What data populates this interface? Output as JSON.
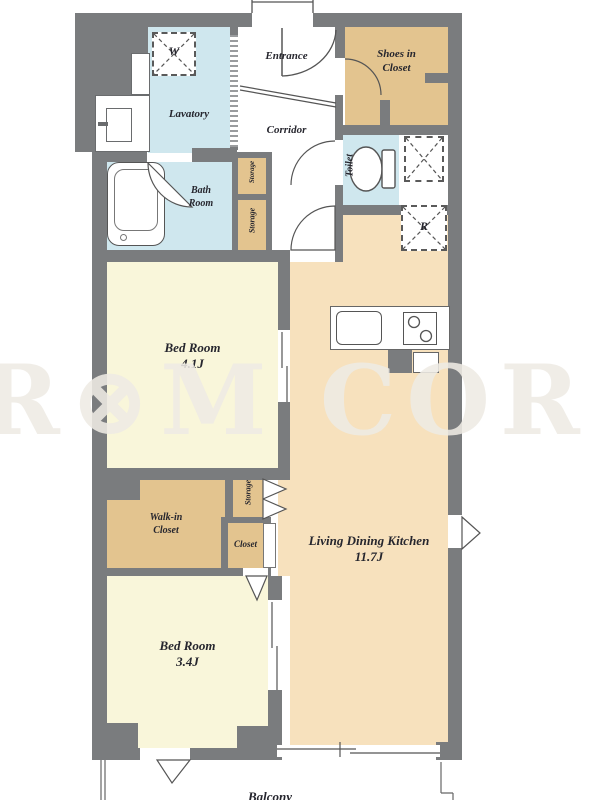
{
  "title": "apartment-floor-plan",
  "watermark": {
    "text": "R⊗M COR"
  },
  "rooms": {
    "lavatory": {
      "label": "Lavatory"
    },
    "entrance": {
      "label": "Entrance"
    },
    "corridor": {
      "label": "Corridor"
    },
    "shoes_in_closet": {
      "line1": "Shoes in",
      "line2": "Closet"
    },
    "bath_room": {
      "line1": "Bath",
      "line2": "Room"
    },
    "toilet": {
      "label": "Toilet"
    },
    "storage_upper": {
      "label": "Storage"
    },
    "storage_lower": {
      "label": "Storage"
    },
    "bedroom1": {
      "name": "Bed Room",
      "size": "4.1J"
    },
    "ldk": {
      "name": "Living Dining Kitchen",
      "size": "11.7J"
    },
    "walk_in_closet": {
      "line1": "Walk-in",
      "line2": "Closet"
    },
    "storage_mid": {
      "label": "Storage"
    },
    "closet": {
      "label": "Closet"
    },
    "bedroom2": {
      "name": "Bed Room",
      "size": "3.4J"
    },
    "balcony": {
      "label": "Balcony"
    }
  },
  "symbols": {
    "washer": "W",
    "fridge": "R"
  },
  "colors": {
    "wall": "#7a7c7e",
    "wet_room_blue": "#cfe7ee",
    "closet_tan": "#e3c48f",
    "ldk_tan": "#f7e1bd",
    "bedroom_cream": "#f9f6da",
    "line": "#555555"
  }
}
